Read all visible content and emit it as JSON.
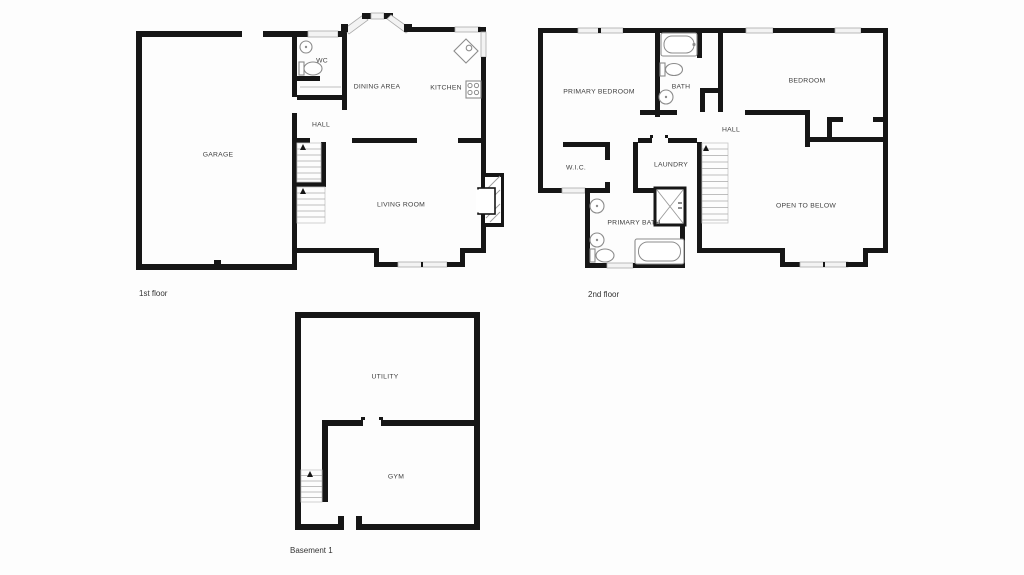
{
  "canvas": {
    "width": 1024,
    "height": 575,
    "background": "#fdfdfd"
  },
  "palette": {
    "wall": "#161616",
    "window_fill": "#f3f3f3",
    "window_stroke": "#ababab",
    "fixture_stroke": "#8c8c8c",
    "stair_stroke": "#a8a8a8",
    "label_color": "#3e3e3e",
    "caption_color": "#333333"
  },
  "floors": {
    "first": {
      "caption": "1st floor",
      "rooms": {
        "garage": "GARAGE",
        "wc": "WC",
        "dining": "DINING AREA",
        "kitchen": "KITCHEN",
        "hall": "HALL",
        "living": "LIVING ROOM"
      },
      "fixtures": [
        "wc-sink",
        "wc-toilet",
        "kitchen-corner-sink",
        "kitchen-stove",
        "fireplace",
        "staircase",
        "bay-window",
        "garage-door",
        "windows"
      ]
    },
    "second": {
      "caption": "2nd floor",
      "rooms": {
        "primary_bedroom": "PRIMARY BEDROOM",
        "bath": "BATH",
        "bedroom": "BEDROOM",
        "hall": "HALL",
        "wic": "W.I.C.",
        "laundry": "LAUNDRY",
        "primary_bath": "PRIMARY BATH",
        "open_below": "OPEN TO BELOW"
      },
      "fixtures": [
        "bathtub",
        "toilet",
        "sink",
        "shower",
        "double-vanity-sinks",
        "primary-toilet",
        "primary-bathtub",
        "staircase",
        "windows",
        "closets"
      ]
    },
    "basement": {
      "caption": "Basement 1",
      "rooms": {
        "utility": "UTILITY",
        "gym": "GYM"
      },
      "fixtures": [
        "staircase",
        "door-opening"
      ]
    }
  }
}
